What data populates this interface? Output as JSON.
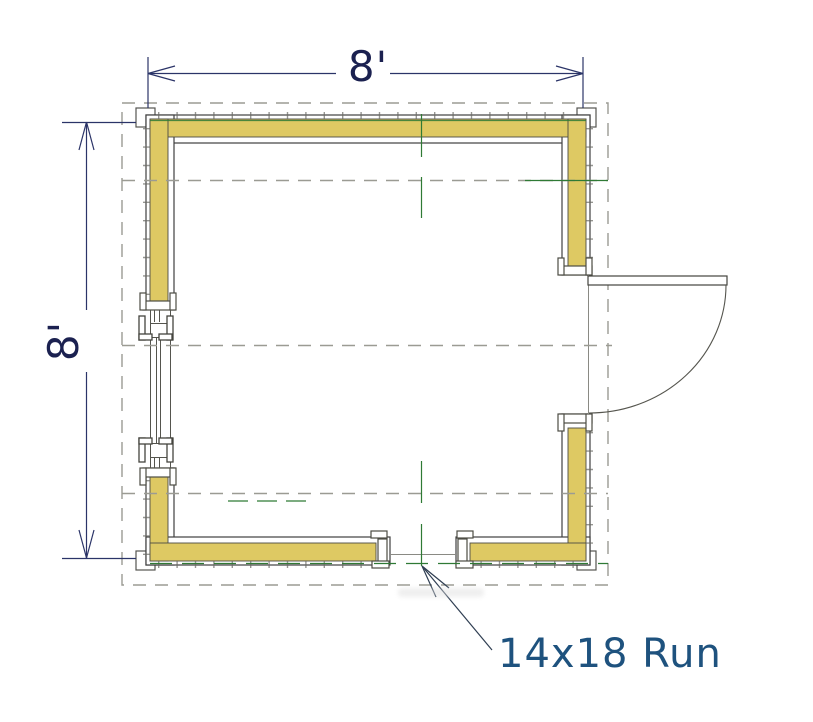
{
  "plan": {
    "dimensions": {
      "top": "8'",
      "left": "8'"
    },
    "annotation": {
      "run_label": "14x18 Run"
    },
    "colors": {
      "wall_fill": "#DEC963",
      "wall_line": "#3F3F3F",
      "trim_line": "#4C4C44",
      "centerline_green": "#2F7A35",
      "guide_dash_gray": "#9B9B93",
      "dimension_navy": "#1B2150",
      "annotation_blue": "#1E527E",
      "background": "#FFFFFF"
    }
  }
}
